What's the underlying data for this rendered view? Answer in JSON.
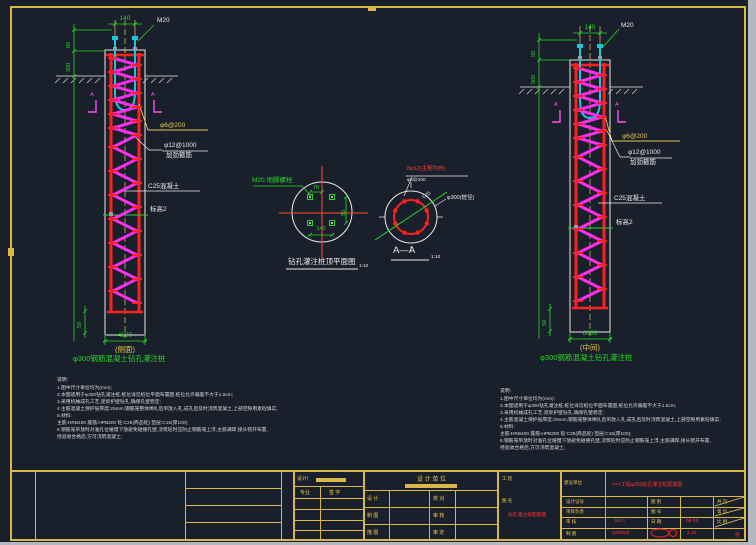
{
  "left_pile": {
    "width_dim": "140",
    "bolt": "M20",
    "dim1": "60",
    "dim2": "200",
    "spiral": "φ6@200",
    "hoop1": "φ12@1000",
    "hoop2": "加劲箍筋",
    "concrete": "C25混凝土",
    "level": "标高2",
    "toe": "50",
    "length": "4300",
    "tag": "(侧面)",
    "caption": "φ300钢筋混凝土钻孔灌注桩",
    "marker": "A"
  },
  "right_pile": {
    "width_dim": "140",
    "bolt": "M20",
    "dim1": "50",
    "dim2": "500",
    "spiral": "φ6@200",
    "hoop1": "φ12@1000",
    "hoop2": "加劲箍筋",
    "concrete": "C25混凝土",
    "level": "标高2",
    "toe": "50",
    "length": "6000",
    "tag": "(中间)",
    "caption": "φ300钢筋混凝土钻孔灌注桩",
    "marker": "A"
  },
  "plan": {
    "leader": "M20 地脚螺栓",
    "d_top": "70",
    "d_right": "90",
    "d_bottom": "140",
    "caption": "钻孔灌注桩顶平面图",
    "scale": "1:10"
  },
  "aa": {
    "bars": "8φ12(主筋均布)",
    "spiral": "φ6@200",
    "grade": "C25",
    "dia": "φ300(桩径)",
    "caption": "A—A",
    "scale": "1:10"
  },
  "notes_left": {
    "title": "说明:",
    "lines": [
      "1.图中尺寸单位均为(mm);",
      "2.本图适用于φ300钻孔灌注桩,桩位详见桩位平面布置图,桩位允许偏差不大于1.5cm;",
      "3.采用机械成孔工艺,泥浆护壁钻孔,确保孔壁稳定;",
      "4.主筋混凝土保护层厚度:25mm;钢筋笼整体绑扎后吊放入孔,成孔后及时浇筑混凝土,上部空隙用素砼填实;",
      "5.材料:",
      "主筋:HRB400  箍筋:HPB300  砼:C25(商品砼)  垫层:C15(厚100);",
      "6.钢筋笼吊放时对准孔位缓慢下放避免碰撞孔壁,浇筑砼时应防止钢筋笼上浮,主筋满焊,接头错开布置,",
      "经验收合格后,方可浇筑混凝土;"
    ]
  },
  "notes_right": {
    "title": "说明:",
    "lines": [
      "1.图中尺寸单位均为(mm);",
      "2.本图适用于φ300钻孔灌注桩,桩位详见桩位平面布置图,桩位允许偏差不大于1.5cm;",
      "3.采用机械成孔工艺,泥浆护壁钻孔,确保孔壁稳定;",
      "4.主筋混凝土保护层厚度:25mm;钢筋笼整体绑扎后吊放入孔,成孔后及时浇筑混凝土,上部空隙用素砼填实;",
      "5.材料:",
      "主筋:HRB400  箍筋:HPB300  砼:C25(商品砼)  垫层:C15(厚100);",
      "6.钢筋笼吊放时对准孔位缓慢下放避免碰撞孔壁,浇筑砼时应防止钢筋笼上浮,主筋满焊,接头错开布置,",
      "经验收合格后,方可浇筑混凝土;"
    ]
  },
  "tb": {
    "sign_head": "设计/",
    "col1": "专业",
    "col2": "签  字",
    "unit": "设 计 单 位",
    "roles": [
      [
        "设 计",
        "校 对"
      ],
      [
        "制 图",
        "审 核"
      ],
      [
        "描 图",
        "审 定"
      ]
    ],
    "proj_label": "工 程",
    "name_label": "图 名",
    "sheet_title": "钻孔灌注桩配筋图",
    "owner_label": "建设单位",
    "project_name": "×××工程φ300钻孔灌注桩配筋图",
    "rows": [
      [
        "设计证号",
        "",
        "图 别",
        "",
        "共  页"
      ],
      [
        "项目负责",
        "",
        "图 号",
        "",
        "第  页"
      ],
      [
        "审  核",
        "No.1",
        "日 期",
        "08-06",
        "比  例"
      ],
      [
        "制  图",
        "2005/06",
        "",
        "1:20",
        "张"
      ]
    ]
  }
}
